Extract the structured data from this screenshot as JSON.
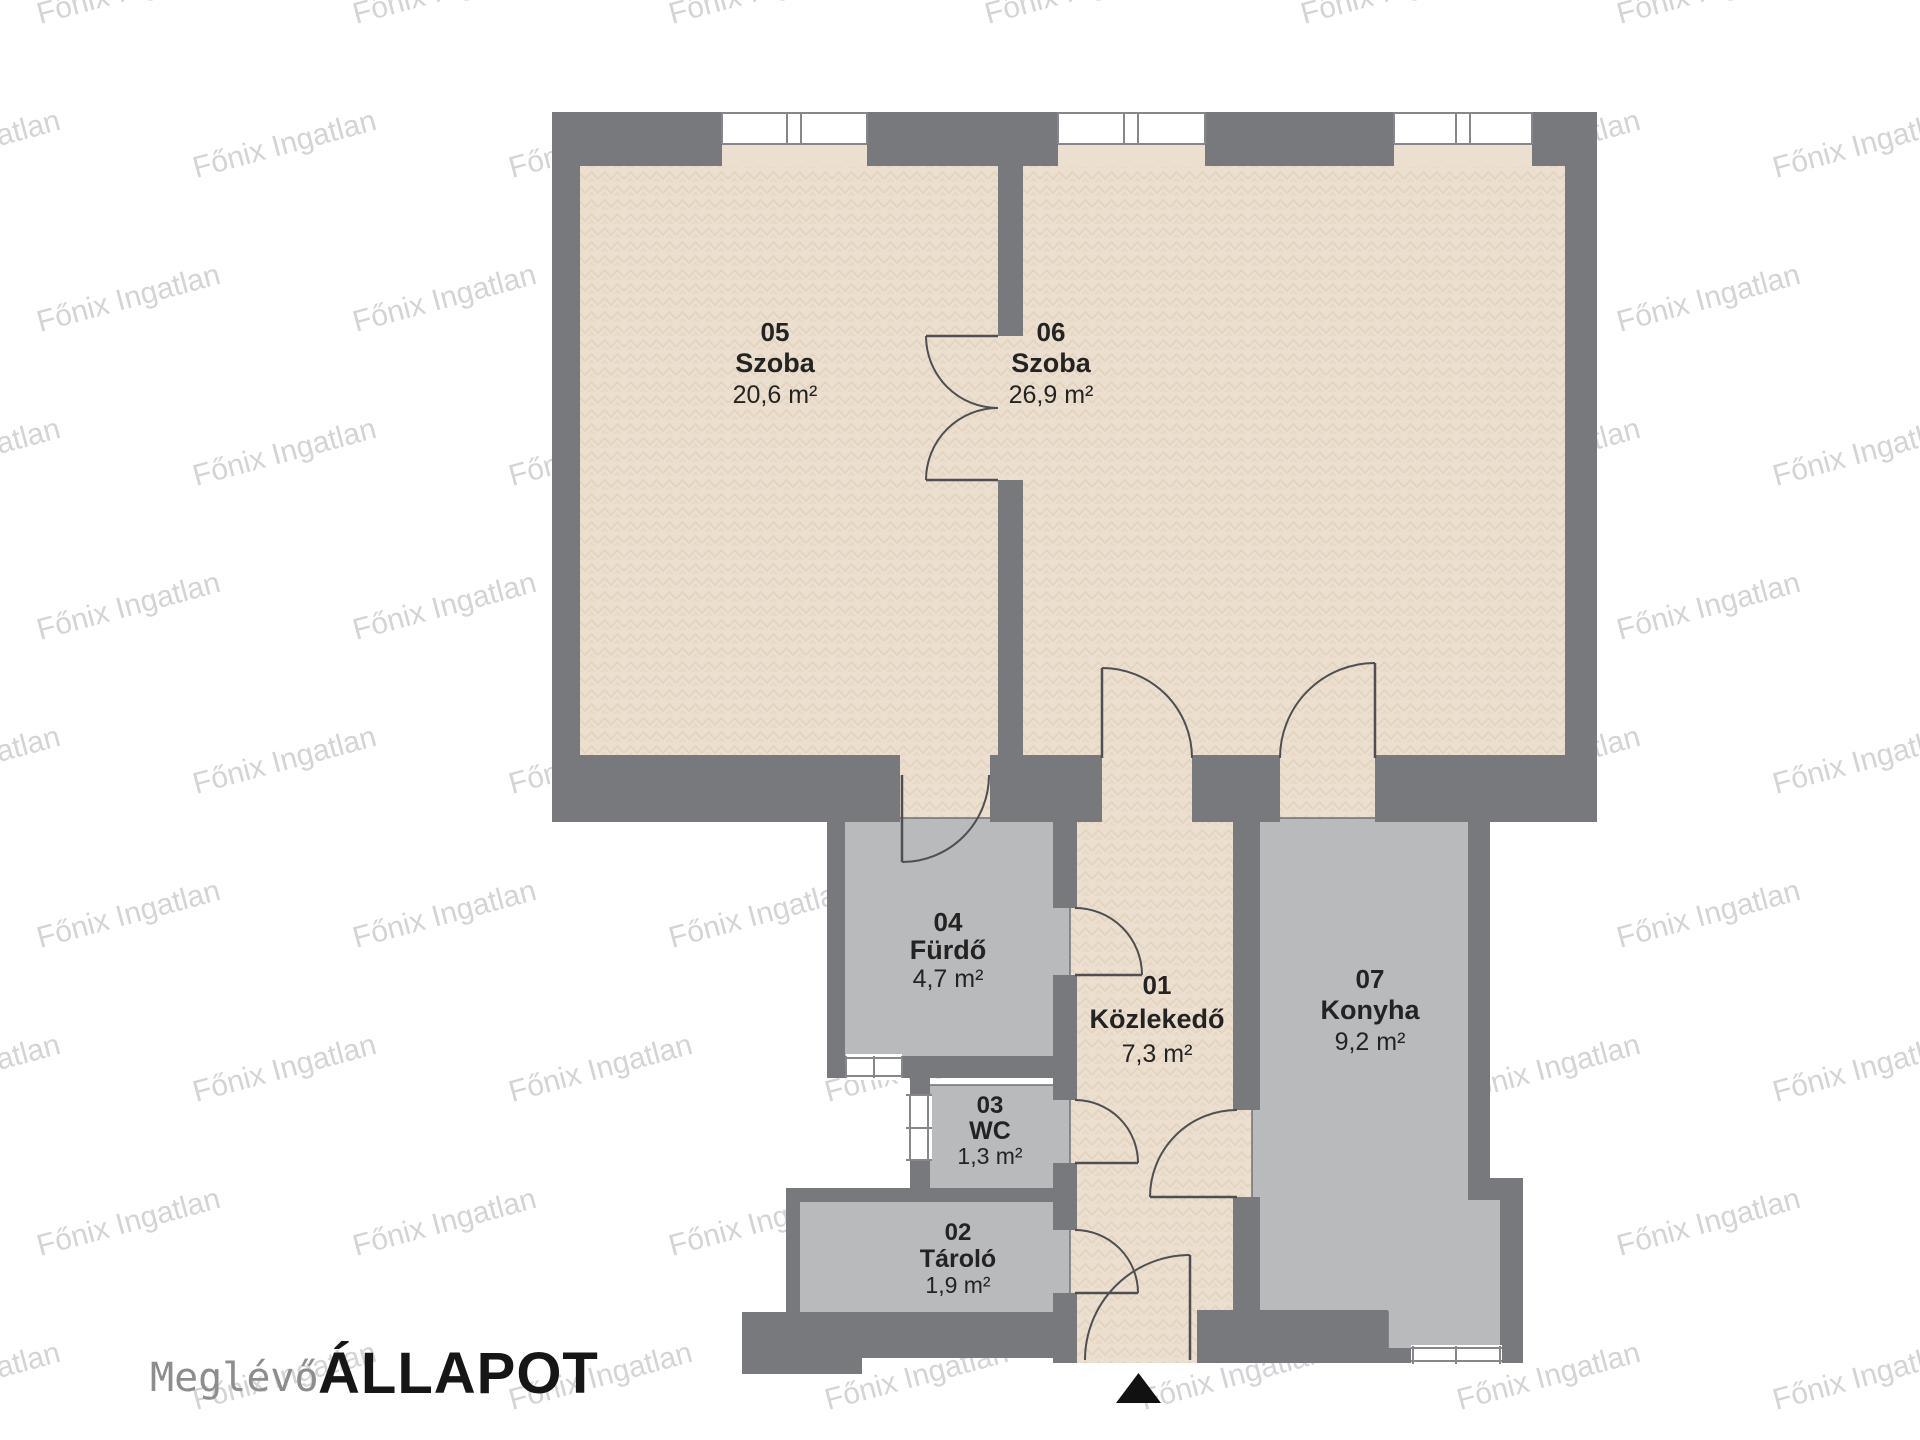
{
  "title": {
    "prefix": "Meglévő",
    "main": "ÁLLAPOT"
  },
  "watermark": {
    "text": "Főnix Ingatlan"
  },
  "entrance": {
    "icon": "entrance-arrow"
  },
  "colors": {
    "wall": "#77797c",
    "floor-beige": "#ecdfcf",
    "floor-beige-line": "#dbc9b1",
    "floor-gray": "#b8babc",
    "floor-gray-edge": "#6f7173",
    "door-line": "#4d4f52",
    "window-line": "#85878a",
    "label": "#232323",
    "title-prefix": "#8d8d8d",
    "title-main": "#161616",
    "watermark-color": "#8f9194",
    "background": "#ffffff"
  },
  "rooms": [
    {
      "number": "01",
      "name": "Közlekedő",
      "area": "7,3 m²"
    },
    {
      "number": "02",
      "name": "Tároló",
      "area": "1,9 m²"
    },
    {
      "number": "03",
      "name": "WC",
      "area": "1,3 m²"
    },
    {
      "number": "04",
      "name": "Fürdő",
      "area": "4,7 m²"
    },
    {
      "number": "05",
      "name": "Szoba",
      "area": "20,6 m²"
    },
    {
      "number": "06",
      "name": "Szoba",
      "area": "26,9 m²"
    },
    {
      "number": "07",
      "name": "Konyha",
      "area": "9,2 m²"
    }
  ]
}
